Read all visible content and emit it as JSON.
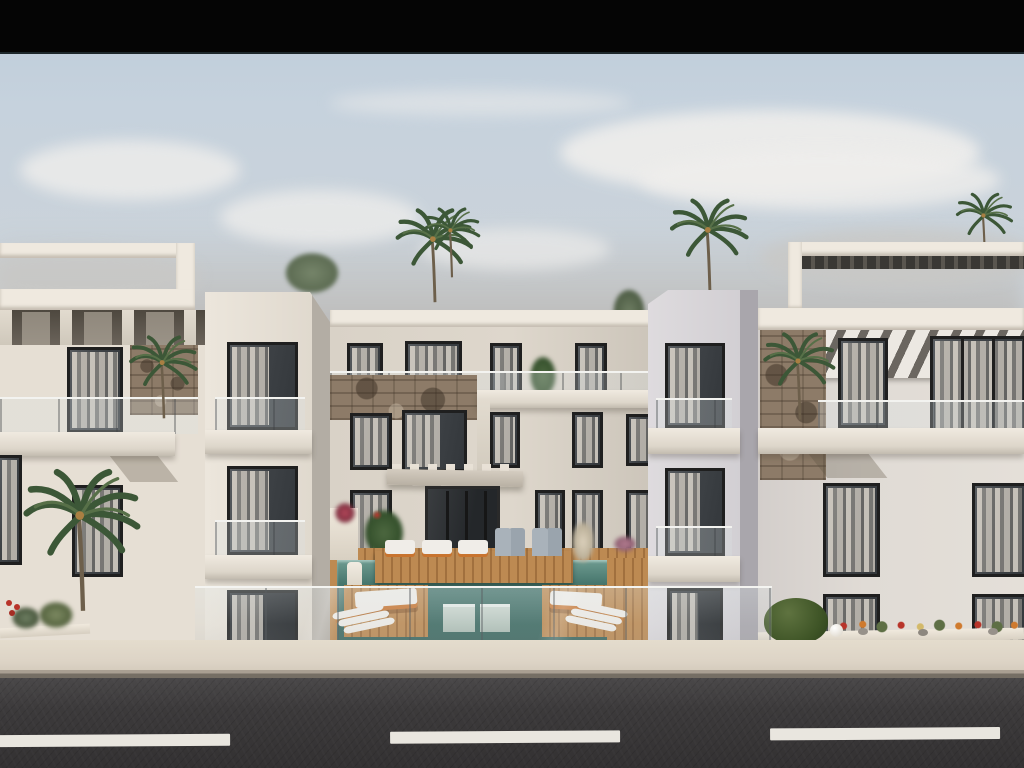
{
  "scene": {
    "label": "Architectural rendering of a modern apartment complex",
    "description": "Photorealistic daytime 3D rendering of a white three-story apartment complex: left and right wings with projecting balcony towers, rooftop pergolas, stone accent walls and sheer-curtained windows; a central courtyard with a teal swimming pool, wooden sun decks, white and orange loungers and palm trees behind a glass fence; a beige sidewalk with planters and flower beds; a dark asphalt road with three dashed white lane markings in the foreground; partly cloudy blue sky and a black letterbox bar across the top.",
    "time_of_day": "daytime",
    "text_content": "none"
  },
  "palette": {
    "letterbox": "#050505",
    "letterbox-edge": "#1d272b",
    "sky-top": "#bdccdb",
    "sky-mid": "#ccd3d9",
    "horizon-haze": "#b7b3ae",
    "cloud": "#efeeec",
    "facade-warm": "#e6dfd4",
    "facade-mid": "#d9d2c7",
    "facade-cool": "#d9d6d9",
    "facade-shade": "#b3ada4",
    "parapet": "#efe9df",
    "stone": "#8d7b68",
    "window-glass": "#3e4246",
    "window-frame": "#1f1f1f",
    "curtain": "#ddd6ca",
    "pool-water": "#46756c",
    "pool-deep": "#3a665e",
    "deck-wood": "#b9854e",
    "lounger-orange": "#c8742f",
    "lounger-white": "#f0ede8",
    "awning-dark": "#6b6660",
    "foliage": "#3c5737",
    "foliage-light": "#577048",
    "sidewalk": "#ddd4c6",
    "curb": "#968e82",
    "road": "#3c3a3b",
    "road-marking": "#e9e6df"
  },
  "objects": {
    "buildings": 3,
    "visible_floors_per_building": 3,
    "palm_trees": 7,
    "rooftop_pergolas": 2,
    "pool_count": 1,
    "sun_loungers_approx": 12,
    "road_dash_count": 3,
    "letterbox_bar_height_px": 52
  }
}
